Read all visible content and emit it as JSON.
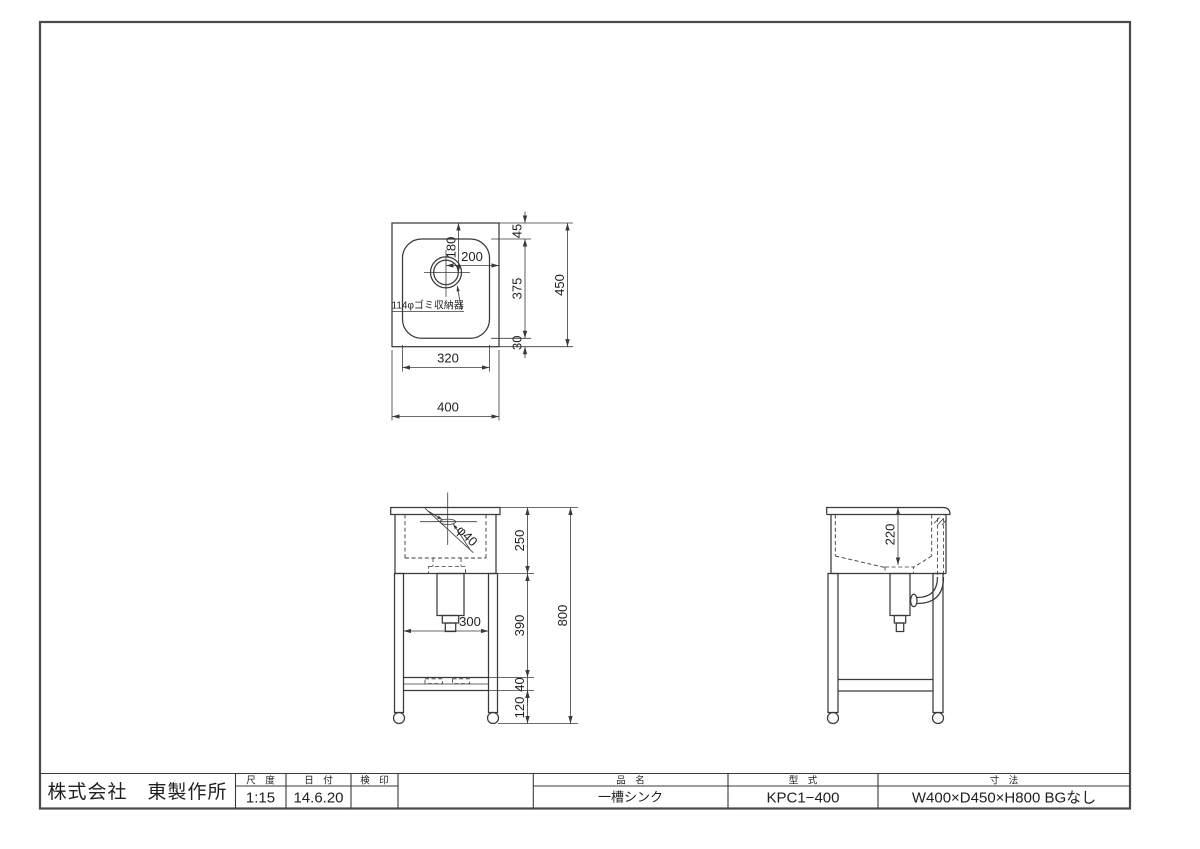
{
  "colors": {
    "line": "#3a3a3a",
    "text": "#1f1f1f",
    "background": "#ffffff"
  },
  "title_block": {
    "company": "株式会社　東製作所",
    "scale": {
      "label": "尺　度",
      "value": "1:15"
    },
    "date": {
      "label": "日　付",
      "value": "14.6.20"
    },
    "stamp": {
      "label": "検　印",
      "value": ""
    },
    "product": {
      "label": "品　名",
      "value": "一槽シンク"
    },
    "model": {
      "label": "型　式",
      "value": "KPC1−400"
    },
    "size": {
      "label": "寸　法",
      "value": "W400×D450×H800 BGなし"
    }
  },
  "plan_view": {
    "drain_note": "114φゴミ収納器",
    "dim_drain_offset_y": "180",
    "dim_drain_offset_x": "200",
    "dim_back_margin": "45",
    "dim_bowl_depth": "375",
    "dim_front_margin": "30",
    "dim_overall_depth": "450",
    "dim_bowl_width": "320",
    "dim_overall_width": "400"
  },
  "front_view": {
    "dim_body_height": "250",
    "dim_upper_leg": "390",
    "dim_frame": "40",
    "dim_lower_leg": "120",
    "dim_overall_height": "800",
    "dim_leg_span": "300",
    "drain_diameter": "φ40"
  },
  "side_view": {
    "dim_bowl_inner_depth": "220"
  }
}
